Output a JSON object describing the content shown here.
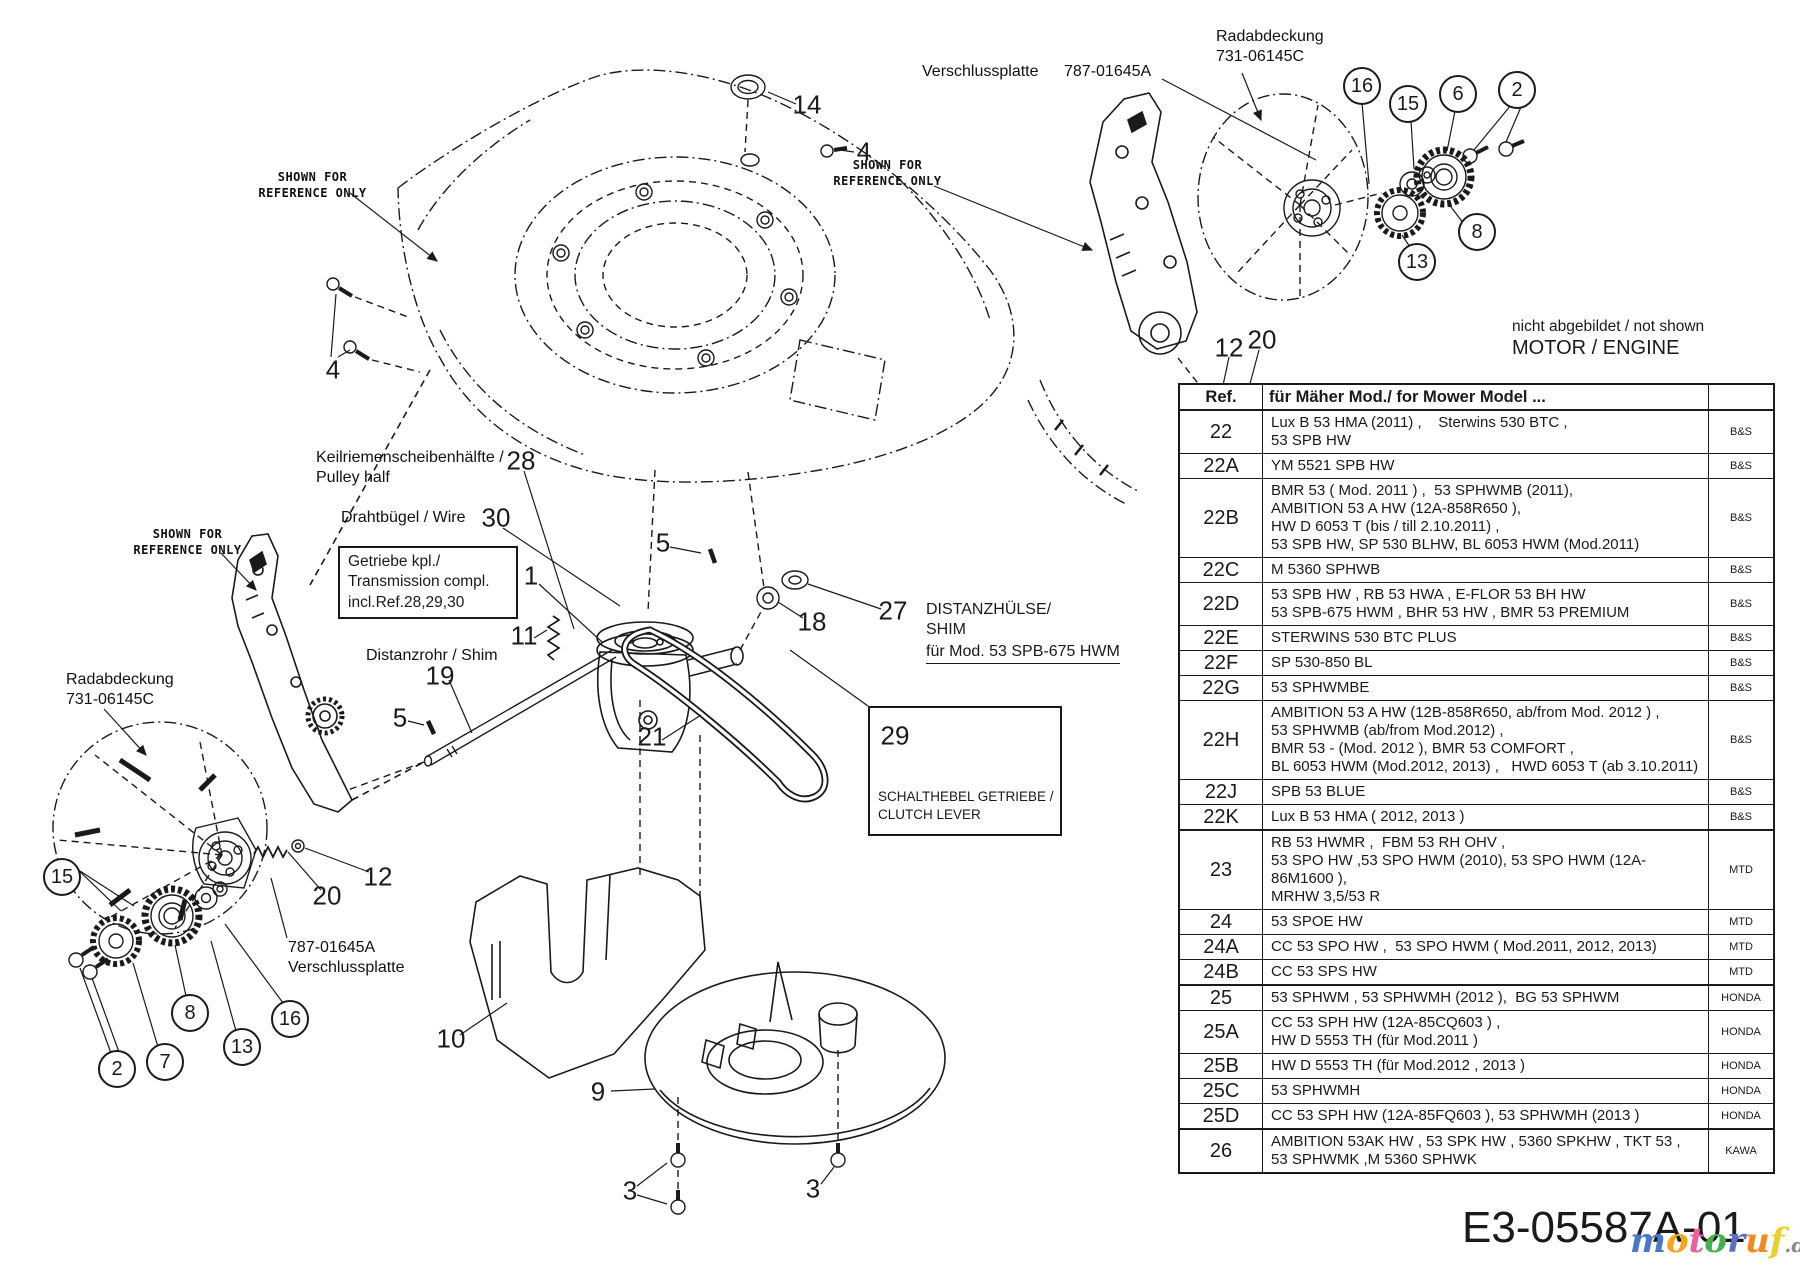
{
  "labels": {
    "shown_for_reference": "SHOWN FOR\nREFERENCE ONLY",
    "radabdeckung": "Radabdeckung\n731-06145C",
    "verschlussplatte_name": "Verschlussplatte",
    "verschlussplatte_part": "787-01645A",
    "verschlussplatte_left": "787-01645A\nVerschlussplatte",
    "keilriemen": "Keilriemenscheibenhälfte /\nPulley half",
    "drahtbuegel": "Drahtbügel / Wire",
    "getriebe_box": "Getriebe kpl./\nTransmission compl.\nincl.Ref.28,29,30",
    "distanzrohr": "Distanzrohr / Shim",
    "distanzhuelse_title": "DISTANZHÜLSE/\nSHIM",
    "distanzhuelse_note": "für Mod. 53 SPB-675 HWM",
    "schalthebel": "SCHALTHEBEL GETRIEBE /\nCLUTCH LEVER",
    "nicht_abgebildet": "nicht abgebildet / not shown",
    "motor_engine": "MOTOR / ENGINE"
  },
  "callouts": {
    "plain": [
      {
        "n": "14"
      },
      {
        "n": "4"
      },
      {
        "n": "4"
      },
      {
        "n": "28"
      },
      {
        "n": "30"
      },
      {
        "n": "1"
      },
      {
        "n": "11"
      },
      {
        "n": "5"
      },
      {
        "n": "18"
      },
      {
        "n": "27"
      },
      {
        "n": "19"
      },
      {
        "n": "5"
      },
      {
        "n": "21"
      },
      {
        "n": "12"
      },
      {
        "n": "20"
      },
      {
        "n": "12"
      },
      {
        "n": "20"
      },
      {
        "n": "10"
      },
      {
        "n": "9"
      },
      {
        "n": "3"
      },
      {
        "n": "3"
      },
      {
        "n": "29"
      }
    ],
    "circled": [
      {
        "n": "16"
      },
      {
        "n": "15"
      },
      {
        "n": "6"
      },
      {
        "n": "2"
      },
      {
        "n": "8"
      },
      {
        "n": "13"
      },
      {
        "n": "15"
      },
      {
        "n": "8"
      },
      {
        "n": "16"
      },
      {
        "n": "13"
      },
      {
        "n": "7"
      },
      {
        "n": "2"
      }
    ]
  },
  "table": {
    "header": {
      "ref": "Ref.",
      "model": "für Mäher Mod./ for Mower Model ...",
      "brand": ""
    },
    "rows": [
      {
        "ref": "22",
        "models": "Lux B 53 HMA (2011) ,    Sterwins 530 BTC ,\n53 SPB HW",
        "brand": "B&S",
        "thick": false
      },
      {
        "ref": "22A",
        "models": "YM 5521 SPB HW",
        "brand": "B&S",
        "thick": false
      },
      {
        "ref": "22B",
        "models": "BMR 53 ( Mod. 2011 ) ,  53 SPHWMB (2011),\nAMBITION 53 A HW (12A-858R650 ),\nHW D 6053 T (bis / till 2.10.2011) ,\n53 SPB HW, SP 530 BLHW, BL 6053 HWM (Mod.2011)",
        "brand": "B&S",
        "thick": false
      },
      {
        "ref": "22C",
        "models": "M 5360 SPHWB",
        "brand": "B&S",
        "thick": false
      },
      {
        "ref": "22D",
        "models": "53 SPB HW , RB 53 HWA , E-FLOR 53 BH HW\n53 SPB-675 HWM , BHR 53 HW , BMR 53 PREMIUM",
        "brand": "B&S",
        "thick": false
      },
      {
        "ref": "22E",
        "models": "STERWINS 530 BTC PLUS",
        "brand": "B&S",
        "thick": false
      },
      {
        "ref": "22F",
        "models": "SP 530-850 BL",
        "brand": "B&S",
        "thick": false
      },
      {
        "ref": "22G",
        "models": "53 SPHWMBE",
        "brand": "B&S",
        "thick": false
      },
      {
        "ref": "22H",
        "models": "AMBITION 53 A HW (12B-858R650, ab/from Mod. 2012 ) ,\n53 SPHWMB (ab/from Mod.2012) ,\nBMR 53 - (Mod. 2012 ), BMR 53 COMFORT ,\nBL 6053 HWM (Mod.2012, 2013) ,   HWD 6053 T (ab 3.10.2011)",
        "brand": "B&S",
        "thick": false
      },
      {
        "ref": "22J",
        "models": "SPB 53 BLUE",
        "brand": "B&S",
        "thick": false
      },
      {
        "ref": "22K",
        "models": "Lux B 53 HMA ( 2012, 2013 )",
        "brand": "B&S",
        "thick": false
      },
      {
        "ref": "23",
        "models": "RB 53 HWMR ,  FBM 53 RH OHV ,\n53 SPO HW ,53 SPO HWM (2010), 53 SPO HWM (12A-86M1600 ),\nMRHW 3,5/53 R",
        "brand": "MTD",
        "thick": true
      },
      {
        "ref": "24",
        "models": "53 SPOE HW",
        "brand": "MTD",
        "thick": false
      },
      {
        "ref": "24A",
        "models": "CC 53 SPO HW ,  53 SPO HWM ( Mod.2011, 2012, 2013)",
        "brand": "MTD",
        "thick": false
      },
      {
        "ref": "24B",
        "models": "CC 53 SPS HW",
        "brand": "MTD",
        "thick": false
      },
      {
        "ref": "25",
        "models": "53 SPHWM , 53 SPHWMH (2012 ),  BG 53 SPHWM",
        "brand": "HONDA",
        "thick": true
      },
      {
        "ref": "25A",
        "models": "CC 53 SPH HW (12A-85CQ603 ) ,\nHW D 5553 TH (für Mod.2011 )",
        "brand": "HONDA",
        "thick": false
      },
      {
        "ref": "25B",
        "models": "HW D 5553 TH (für Mod.2012 , 2013 )",
        "brand": "HONDA",
        "thick": false
      },
      {
        "ref": "25C",
        "models": "53 SPHWMH",
        "brand": "HONDA",
        "thick": false
      },
      {
        "ref": "25D",
        "models": "CC 53 SPH HW (12A-85FQ603 ), 53 SPHWMH (2013 )",
        "brand": "HONDA",
        "thick": false
      },
      {
        "ref": "26",
        "models": "AMBITION 53AK HW , 53 SPK HW , 5360 SPKHW , TKT 53 ,\n53 SPHWMK ,M 5360 SPHWK",
        "brand": "KAWA",
        "thick": true
      }
    ]
  },
  "footer": {
    "part_number": "E3-05587A-01",
    "watermark_suffix": ".de",
    "watermark_letters": [
      {
        "ch": "m",
        "color": "#4a77c9"
      },
      {
        "ch": "o",
        "color": "#f5a61f"
      },
      {
        "ch": "t",
        "color": "#ee5fa0"
      },
      {
        "ch": "o",
        "color": "#46b14c"
      },
      {
        "ch": "r",
        "color": "#5b6fc9"
      },
      {
        "ch": "u",
        "color": "#ef8b1f"
      },
      {
        "ch": "f",
        "color": "#e8d02f"
      }
    ]
  }
}
